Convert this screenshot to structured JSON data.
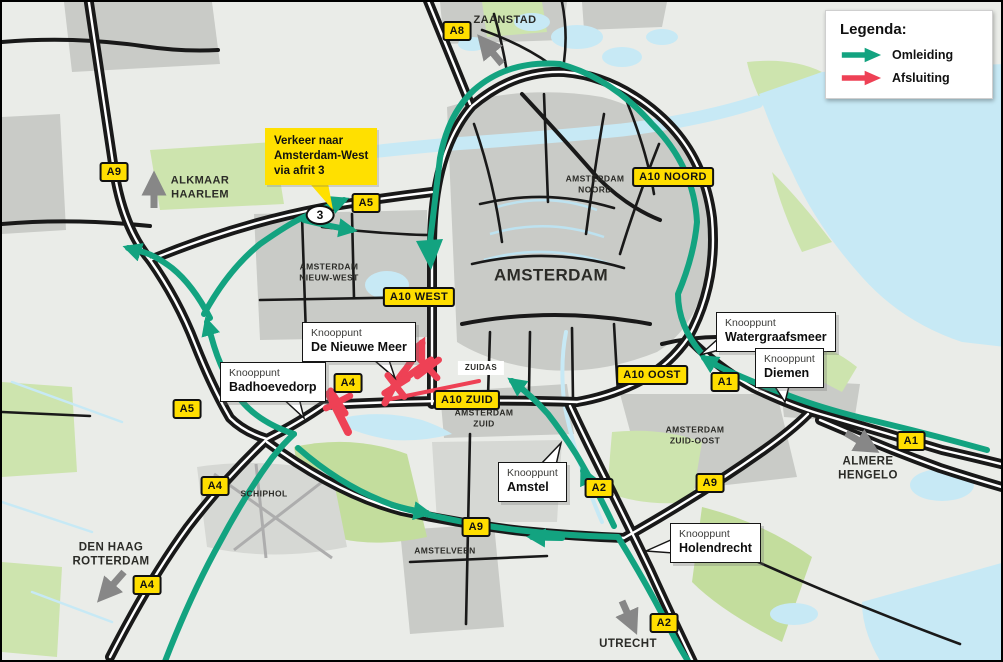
{
  "legend": {
    "title": "Legenda:",
    "items": [
      {
        "name": "omleiding",
        "label": "Omleiding",
        "color": "#13A380"
      },
      {
        "name": "afsluiting",
        "label": "Afsluiting",
        "color": "#EE4155"
      }
    ]
  },
  "colors": {
    "detour": "#13A380",
    "closure": "#EE4155",
    "badge_bg": "#FFDE00",
    "direction_arrow": "#878787"
  },
  "notice": {
    "lines": [
      "Verkeer naar",
      "Amsterdam-West",
      "via afrit 3"
    ],
    "x": 263,
    "y": 126,
    "tip": "303,176 325,176 331,208"
  },
  "exit_badge": {
    "label": "3",
    "x": 318,
    "y": 213
  },
  "road_badges": [
    {
      "label": "A8",
      "x": 455,
      "y": 29
    },
    {
      "label": "A9",
      "x": 112,
      "y": 170
    },
    {
      "label": "A5",
      "x": 364,
      "y": 201
    },
    {
      "label": "A10 NOORD",
      "x": 671,
      "y": 175
    },
    {
      "label": "A10 WEST",
      "x": 417,
      "y": 295
    },
    {
      "label": "A10 OOST",
      "x": 650,
      "y": 373
    },
    {
      "label": "A1",
      "x": 723,
      "y": 380
    },
    {
      "label": "A4",
      "x": 346,
      "y": 381
    },
    {
      "label": "A10 ZUID",
      "x": 465,
      "y": 398
    },
    {
      "label": "A5",
      "x": 185,
      "y": 407
    },
    {
      "label": "A1",
      "x": 909,
      "y": 439
    },
    {
      "label": "A4",
      "x": 213,
      "y": 484
    },
    {
      "label": "A9",
      "x": 708,
      "y": 481
    },
    {
      "label": "A2",
      "x": 597,
      "y": 486
    },
    {
      "label": "A9",
      "x": 474,
      "y": 525
    },
    {
      "label": "A4",
      "x": 145,
      "y": 583
    },
    {
      "label": "A2",
      "x": 662,
      "y": 621
    }
  ],
  "city_labels": [
    {
      "lines": [
        "ZAANSTAD"
      ],
      "x": 503,
      "y": 19,
      "size": 11
    },
    {
      "lines": [
        "ALKMAAR",
        "HAARLEM"
      ],
      "x": 198,
      "y": 186,
      "size": 11
    },
    {
      "lines": [
        "AMSTERDAM",
        "NOORD"
      ],
      "x": 593,
      "y": 182,
      "size": 8.5
    },
    {
      "lines": [
        "AMSTERDAM"
      ],
      "x": 549,
      "y": 273,
      "size": 17
    },
    {
      "lines": [
        "AMSTERDAM",
        "NIEUW-WEST"
      ],
      "x": 327,
      "y": 270,
      "size": 8.5
    },
    {
      "lines": [
        "ZUIDAS"
      ],
      "x": 479,
      "y": 366,
      "size": 8,
      "bg": "white"
    },
    {
      "lines": [
        "AMSTERDAM",
        "ZUID"
      ],
      "x": 482,
      "y": 416,
      "size": 8.5
    },
    {
      "lines": [
        "AMSTERDAM",
        "ZUID-OOST"
      ],
      "x": 693,
      "y": 433,
      "size": 8.5
    },
    {
      "lines": [
        "SCHIPHOL"
      ],
      "x": 262,
      "y": 492,
      "size": 8.5
    },
    {
      "lines": [
        "AMSTELVEEN"
      ],
      "x": 443,
      "y": 549,
      "size": 8.5
    },
    {
      "lines": [
        "DEN HAAG",
        "ROTTERDAM"
      ],
      "x": 109,
      "y": 553,
      "size": 11.5
    },
    {
      "lines": [
        "ALMERE",
        "HENGELO"
      ],
      "x": 866,
      "y": 467,
      "size": 11.5
    },
    {
      "lines": [
        "UTRECHT"
      ],
      "x": 626,
      "y": 642,
      "size": 11.5
    }
  ],
  "callouts": [
    {
      "line1": "Knooppunt",
      "line2": "De Nieuwe Meer",
      "x": 300,
      "y": 320,
      "tip": "365,352 385,352 393,376"
    },
    {
      "line1": "Knooppunt",
      "line2": "Badhoevedorp",
      "x": 218,
      "y": 360,
      "tip": "278,394 296,392 302,416"
    },
    {
      "line1": "Knooppunt",
      "line2": "Watergraafsmeer",
      "x": 714,
      "y": 310,
      "tip": "717,336 733,344 698,353"
    },
    {
      "line1": "Knooppunt",
      "line2": "Diemen",
      "x": 753,
      "y": 346,
      "tip": "770,380 788,380 783,400"
    },
    {
      "line1": "Knooppunt",
      "line2": "Amstel",
      "x": 496,
      "y": 460,
      "tip": "538,463 554,463 559,441"
    },
    {
      "line1": "Knooppunt",
      "line2": "Holendrecht",
      "x": 668,
      "y": 521,
      "tip": "671,537 671,551 644,549"
    }
  ],
  "direction_arrows": [
    {
      "toward": "zaanstad",
      "x1": 500,
      "y1": 62,
      "x2": 480,
      "y2": 38
    },
    {
      "toward": "alkmaar-haarlem",
      "x1": 152,
      "y1": 206,
      "x2": 152,
      "y2": 176
    },
    {
      "toward": "den-haag-rotterdam",
      "x1": 122,
      "y1": 570,
      "x2": 100,
      "y2": 595
    },
    {
      "toward": "almere-hengelo",
      "x1": 844,
      "y1": 431,
      "x2": 871,
      "y2": 447
    },
    {
      "toward": "utrecht",
      "x1": 620,
      "y1": 599,
      "x2": 632,
      "y2": 626
    }
  ],
  "closures": {
    "x_marks": [
      {
        "x": 336,
        "y": 400,
        "rot": 15
      },
      {
        "x": 394,
        "y": 384,
        "rot": 10
      },
      {
        "x": 426,
        "y": 366,
        "rot": 5
      }
    ]
  }
}
